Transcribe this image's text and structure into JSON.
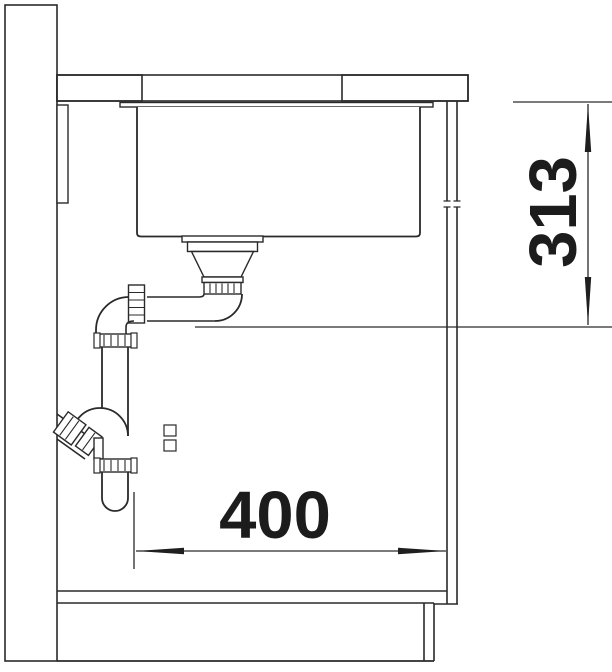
{
  "drawing": {
    "kind": "technical-section",
    "subject": "undermount-sink-and-siphon-installation-cross-section",
    "components": [
      "wall",
      "worktop",
      "wall-batten",
      "sink-flange",
      "sink-bowl",
      "strainer-drain",
      "drain-elbow-pipe",
      "siphon-trap",
      "wall-outlet-branch",
      "cabinet-side-panel",
      "cabinet-bottom-shelf",
      "plinth",
      "floor"
    ]
  },
  "dimensions": {
    "vertical": {
      "value": "313",
      "orientation": "vertical"
    },
    "horizontal": {
      "value": "400",
      "orientation": "horizontal"
    }
  },
  "colors": {
    "line": "#2a2a2a",
    "text": "#1c1c1c",
    "background": "#ffffff"
  }
}
